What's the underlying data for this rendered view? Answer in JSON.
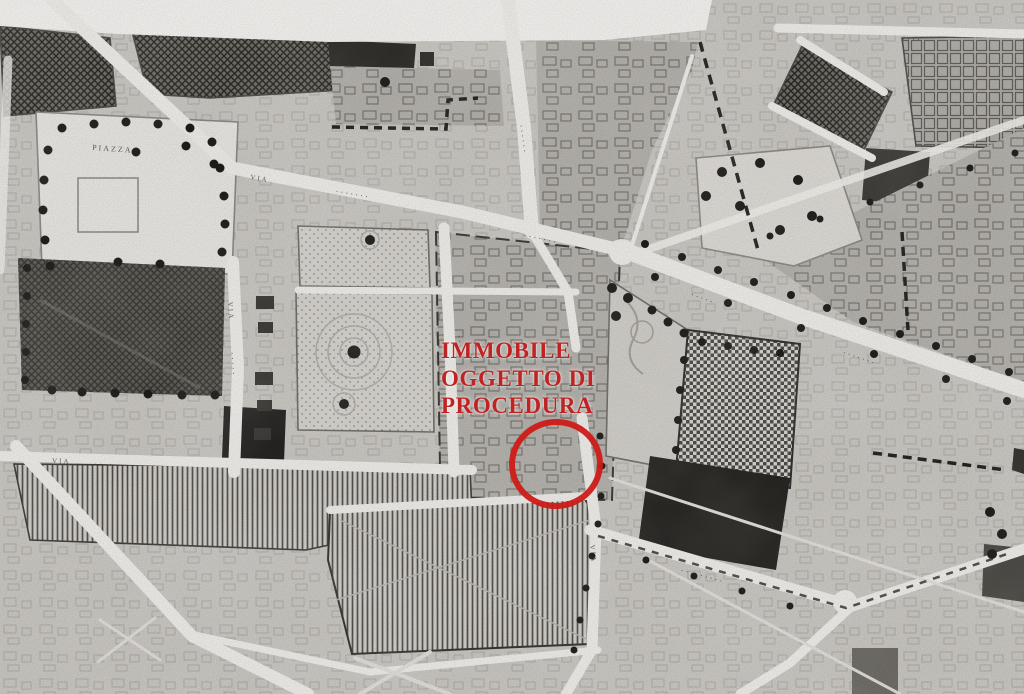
{
  "annotation": {
    "line1": "IMMOBILE",
    "line2": "OGGETTO DI",
    "line3": "PROCEDURA",
    "color": "#bf2322"
  },
  "marker": {
    "shape": "ellipse",
    "color": "#cc1f1a"
  },
  "labels": [
    {
      "text": "PIAZZA"
    },
    {
      "text": "VIA"
    },
    {
      "text": "·······"
    },
    {
      "text": "······"
    },
    {
      "text": "VIA"
    },
    {
      "text": "·····"
    },
    {
      "text": "······"
    },
    {
      "text": "·······"
    },
    {
      "text": "VIA"
    },
    {
      "text": "·····"
    },
    {
      "text": "VIA"
    },
    {
      "text": "·········"
    },
    {
      "text": "·····"
    },
    {
      "text": "····"
    }
  ],
  "colors": {
    "paper": "#cfccc8",
    "road": "#eeece8",
    "dark_block": "#46443f",
    "ink": "#23221f"
  }
}
